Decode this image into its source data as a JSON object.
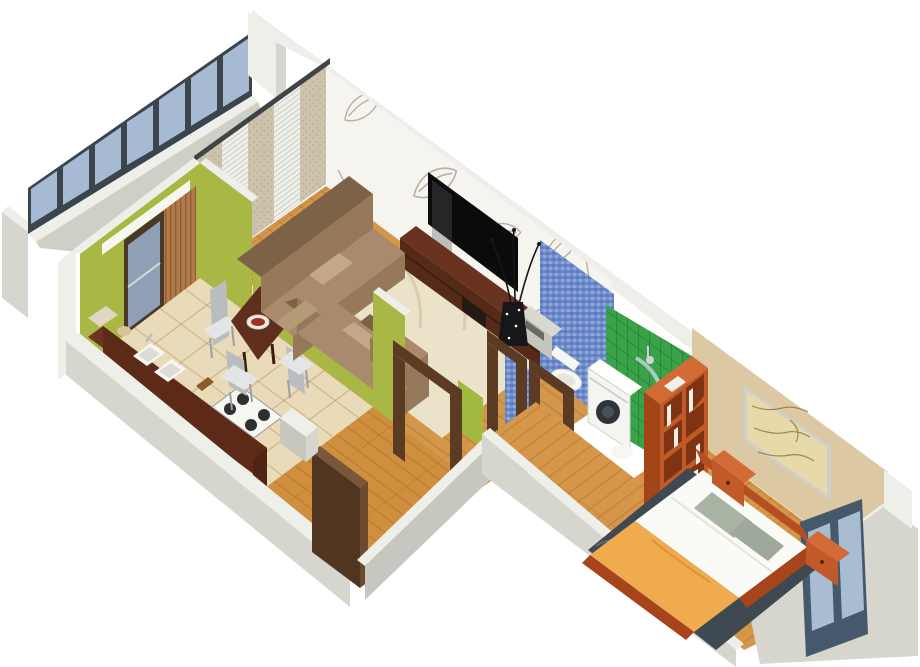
{
  "scene": {
    "title": "3D isometric cutaway render of a one-bedroom apartment floor plan",
    "type": "architectural-visualization",
    "projection": "isometric",
    "background": "#ffffff"
  },
  "palette": {
    "bg": "#ffffff",
    "wallFace": "#d6d6ce",
    "wallTop": "#efefe9",
    "wallShadow": "#c7c7bf",
    "balconyGap": "#cfcfc8",
    "glazeFrame": "#3b454d",
    "glazeGlass": "#a7bad4",
    "greenWall": "#a9b845",
    "limeWall": "#a2b93f",
    "kitchenFloorTile": "#e9dab9",
    "tileLine": "#c9ab79",
    "woodLiving": "#d3974b",
    "woodHall": "#cf8f3e",
    "woodBed": "#d6964a",
    "woodLine": "#a96a22",
    "counterTop": "#6e3423",
    "counterFace": "#5d2a18",
    "counterEnd": "#4f2415",
    "tableWood": "#5f2e1c",
    "chairMetal": "#b9bdc0",
    "chairSeat": "#e3e5e6",
    "sofaBase": "#96785a",
    "sofaDark": "#7d6248",
    "sofaLight": "#a98a6c",
    "cushion": "#c3a887",
    "cushionAlt": "#b59a77",
    "rugLiving": "#ebe2ca",
    "rugLine": "#d9cdae",
    "wallpaperBase": "#f6f4ee",
    "wallpaperLeaf": "#b7b0a4",
    "tvBlack": "#0b0b0b",
    "tvStandFront": "#552a19",
    "tvStandTop": "#6a3320",
    "tvStandEnd": "#46220f",
    "doorBrown": "#503621",
    "doorEdge": "#6b4a30",
    "doorTop": "#7a573a",
    "doorFrame": "#5b3b24",
    "lampStrip": "#f7f7f2",
    "curtain": "#cdc3ad",
    "curtainDot": "#b9ad92",
    "blind": "#efefe9",
    "blindLine": "#c6c6bf",
    "cornice": "#3f4547",
    "slatWood": "#b07a4a",
    "mosaicBase": "#7390cc",
    "mosaicA": "#5b7cc0",
    "mosaicB": "#8fa6da",
    "mosaicC": "#6b87c8",
    "greenTile": "#3aa349",
    "greenTileLine": "#1d7a2e",
    "porcelain": "#f6f6f2",
    "porcelainShade": "#dcdcd4",
    "washerBody": "#f4f4f1",
    "washerDrum": "#2e3338",
    "shelfFront": "#c05a28",
    "shelfCubby": "#7e3413",
    "shelfTop": "#d26b35",
    "shelfSide": "#a34617",
    "bookWhite": "#f0efe9",
    "beigeWall": "#dcc9a3",
    "mapPaper": "#e8d9ab",
    "mapInk": "#9c8650",
    "mapFrame": "#cfcfc9",
    "windowFrame": "#46586b",
    "windowGlass": "#a9bdd2",
    "bedFrame": "#b54f22",
    "bedFrameDark": "#a8441c",
    "blanket": "#f0ab4e",
    "duvet": "#fafaf6",
    "pillowGray": "#a9b3a4",
    "pillowGray2": "#9fa99a",
    "rugBed": "#3e4951",
    "rugBedLine": "#5d6b74",
    "vaseBlack": "#17171a",
    "nicheTop": "#d9d9d2",
    "nicheFace": "#c6c6be",
    "nicheSlot": "#6a6a64"
  },
  "rooms": [
    {
      "id": "balcony",
      "label": "Balcony",
      "features": [
        "full-width glazing band with 7 blue panes",
        "white parapet"
      ]
    },
    {
      "id": "kitchen",
      "label": "Kitchen",
      "features": [
        "dark brown counter with double sink and gas hob",
        "dining table with bowl",
        "chrome chairs",
        "balcony door",
        "wood slat blind",
        "beige tiled floor",
        "olive green walls"
      ]
    },
    {
      "id": "living-room",
      "label": "Living room",
      "features": [
        "brown corner sofa with cushions",
        "armchair",
        "cream swirl rug",
        "wall-mounted TV",
        "dark TV stand",
        "leaf-pattern wallpaper",
        "curtains with venetian blinds",
        "black decorative vase with branches"
      ]
    },
    {
      "id": "hallway",
      "label": "Hallway",
      "features": [
        "entrance door",
        "dark wood door frames",
        "wood floor"
      ]
    },
    {
      "id": "wc",
      "label": "WC",
      "features": [
        "toilet",
        "blue mosaic tile walls",
        "storage niche"
      ]
    },
    {
      "id": "bathroom",
      "label": "Bathroom",
      "features": [
        "washing machine",
        "curved glass shower",
        "green tile walls"
      ]
    },
    {
      "id": "bedroom",
      "label": "Bedroom",
      "features": [
        "double bed with orange bedspread and white duvet",
        "grey pillows",
        "two orange nightstands",
        "framed antique map",
        "dark wave-pattern rug",
        "orange open bookshelf",
        "slate-blue window"
      ]
    }
  ]
}
